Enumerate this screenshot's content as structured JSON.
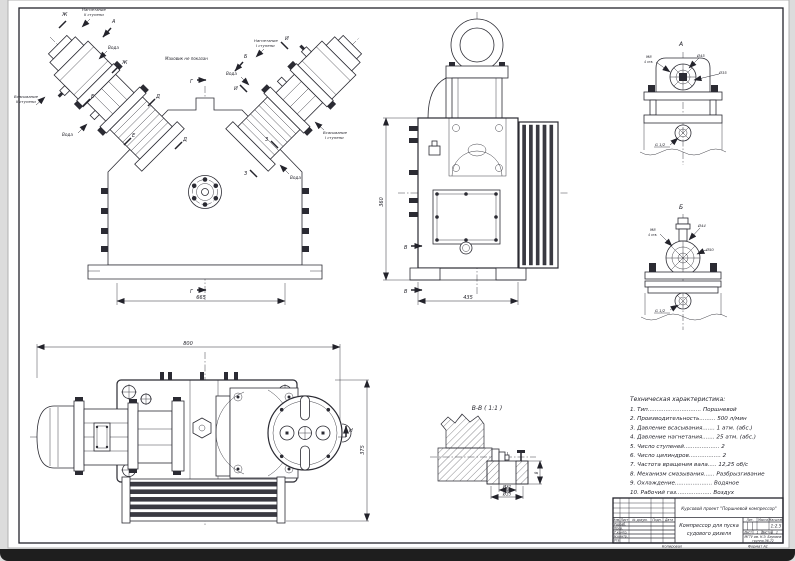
{
  "chrome": {
    "taskbar_color": "#1e1e1e",
    "paper_color": "#ffffff",
    "bg_color": "#dcdcdc",
    "line_color": "#2b2b33"
  },
  "labels": {
    "water": "Вода",
    "flywheel_note": "Маховик не показан",
    "suction": "Всасывание",
    "discharge": "Нагнетание",
    "stage1": "I ступени",
    "stage2": "II ступени",
    "m_a": "А",
    "m_b": "Б",
    "m_v": "В",
    "m_g": "Г",
    "m_d": "Д",
    "m_e": "Е",
    "m_zh": "Ж",
    "m_z": "З",
    "m_i": "И",
    "m_n": "Н",
    "section_bb": "В-В ( 1:1 )"
  },
  "dims": {
    "front_width": "665",
    "side_width": "435",
    "side_height": "360",
    "top_length": "800",
    "top_depth": "375",
    "a_d45": "Ø45",
    "a_d35": "Ø35",
    "b_d44": "Ø44",
    "b_d50": "Ø50",
    "bb_d21": "Ø21",
    "bb_d35": "Ø35",
    "bb_h8": "8",
    "thread": "G 1/2",
    "m8": "М8",
    "holes": "4 отв."
  },
  "tech": {
    "title": "Техническая характеристика:",
    "items": [
      "1. Тип.............................. Поршневой",
      "2. Производительность......... 500 л/мин",
      "3. Давление всасывания....... 1 атм. (абс.)",
      "4. Давление нагнетания....... 25 атм. (абс.)",
      "5. Число ступеней.................... 2",
      "6. Число цилиндров.................. 2",
      "7. Частота вращения вала..... 12,25 об/с",
      "8. Механизм смазывания...... Разбрызгивание",
      "9. Охлаждение..................... Водяное",
      "10. Рабочий газ.................... Воздух"
    ]
  },
  "title_block": {
    "project": "Курсовой проект \"Поршневой компрессор\"",
    "doc_l1": "Компрессор для пуска",
    "doc_l2": "судового дизеля",
    "col_izm": "Изм.",
    "col_list": "Лист",
    "col_doc": "№ докум.",
    "col_podp": "Подп.",
    "col_data": "Дата",
    "row_razrab": "Разраб.",
    "row_prov": "Пров.",
    "row_tkontr": "Т.контр.",
    "row_nkontr": "Н.контр.",
    "row_utv": "Утв.",
    "lit": "Лит.",
    "massa": "Масса",
    "scale_lbl": "Масштаб",
    "scale": "1:2.5",
    "sheet_lbl": "Лист",
    "sheet": "1",
    "sheets_lbl": "Листов",
    "sheets": "1",
    "org1": "МГТУ им. Н.Э. Баумана",
    "org2": "группа Э6-72",
    "copied": "Копировал",
    "format": "Формат А1"
  }
}
